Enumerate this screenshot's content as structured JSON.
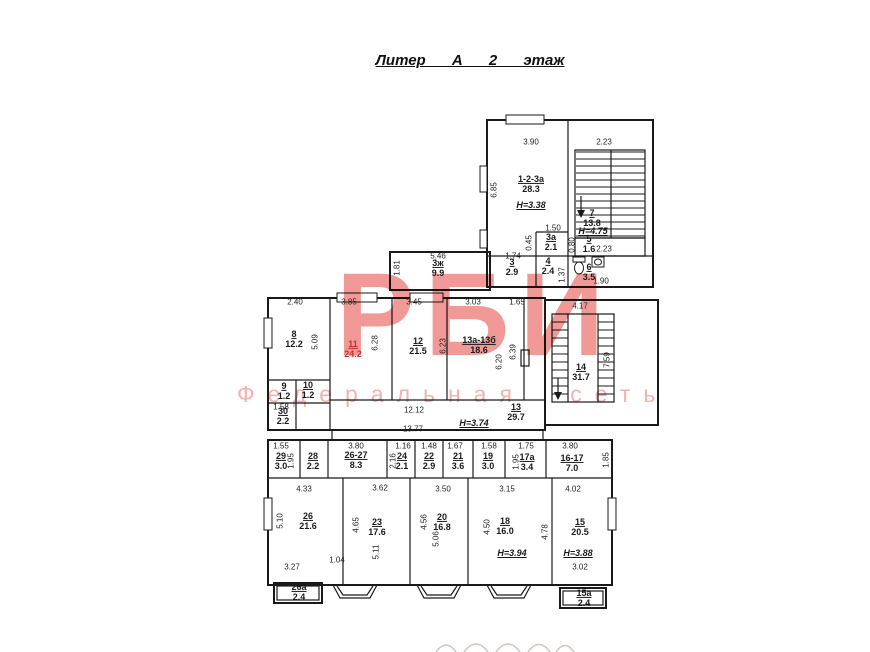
{
  "title": "Литер А 2 этаж",
  "watermark": {
    "big": "РБИ",
    "sub": "Федеральная сеть",
    "big_color": "#ee837f",
    "sub_color": "#f1aeac"
  },
  "rooms": [
    {
      "num": "1-2-3а",
      "area": "28.3",
      "x": 531,
      "y": 184
    },
    {
      "num": "7",
      "area": "13.8",
      "x": 592,
      "y": 218
    },
    {
      "num": "5",
      "area": "1.6",
      "x": 589,
      "y": 244
    },
    {
      "num": "3а",
      "area": "2.1",
      "x": 551,
      "y": 242
    },
    {
      "num": "3",
      "area": "2.9",
      "x": 512,
      "y": 267
    },
    {
      "num": "4",
      "area": "2.4",
      "x": 548,
      "y": 266
    },
    {
      "num": "6",
      "area": "3.5",
      "x": 589,
      "y": 272
    },
    {
      "num": "3ж",
      "area": "9.9",
      "x": 438,
      "y": 268
    },
    {
      "num": "8",
      "area": "12.2",
      "x": 294,
      "y": 339
    },
    {
      "num": "11",
      "area": "24.2",
      "x": 353,
      "y": 349,
      "color": "#c9302f"
    },
    {
      "num": "12",
      "area": "21.5",
      "x": 418,
      "y": 346
    },
    {
      "num": "13а-13б",
      "area": "18.6",
      "x": 479,
      "y": 345
    },
    {
      "num": "9",
      "area": "1.2",
      "x": 284,
      "y": 391
    },
    {
      "num": "10",
      "area": "1.2",
      "x": 308,
      "y": 390
    },
    {
      "num": "30",
      "area": "2.2",
      "x": 283,
      "y": 416
    },
    {
      "num": "13",
      "area": "29.7",
      "x": 516,
      "y": 412
    },
    {
      "num": "14",
      "area": "31.7",
      "x": 581,
      "y": 372
    },
    {
      "num": "29",
      "area": "3.0",
      "x": 281,
      "y": 461
    },
    {
      "num": "28",
      "area": "2.2",
      "x": 313,
      "y": 461
    },
    {
      "num": "26-27",
      "area": "8.3",
      "x": 356,
      "y": 460
    },
    {
      "num": "24",
      "area": "2.1",
      "x": 402,
      "y": 461
    },
    {
      "num": "22",
      "area": "2.9",
      "x": 429,
      "y": 461
    },
    {
      "num": "21",
      "area": "3.6",
      "x": 458,
      "y": 461
    },
    {
      "num": "19",
      "area": "3.0",
      "x": 488,
      "y": 461
    },
    {
      "num": "17а",
      "area": "3.4",
      "x": 527,
      "y": 462
    },
    {
      "num": "16-17",
      "area": "7.0",
      "x": 572,
      "y": 463
    },
    {
      "num": "26",
      "area": "21.6",
      "x": 308,
      "y": 521
    },
    {
      "num": "23",
      "area": "17.6",
      "x": 377,
      "y": 527
    },
    {
      "num": "20",
      "area": "16.8",
      "x": 442,
      "y": 522
    },
    {
      "num": "18",
      "area": "16.0",
      "x": 505,
      "y": 526
    },
    {
      "num": "15",
      "area": "20.5",
      "x": 580,
      "y": 527
    },
    {
      "num": "26а",
      "area": "2.4",
      "x": 299,
      "y": 592
    },
    {
      "num": "15а",
      "area": "2.4",
      "x": 584,
      "y": 598
    }
  ],
  "hlabels": [
    {
      "text": "Н=3.38",
      "x": 531,
      "y": 205
    },
    {
      "text": "Н=4.75",
      "x": 593,
      "y": 231
    },
    {
      "text": "Н=3.74",
      "x": 474,
      "y": 423
    },
    {
      "text": "Н=3.94",
      "x": 512,
      "y": 553
    },
    {
      "text": "Н=3.88",
      "x": 578,
      "y": 553
    }
  ],
  "dims": [
    {
      "t": "3.90",
      "x": 531,
      "y": 142
    },
    {
      "t": "2.23",
      "x": 604,
      "y": 142
    },
    {
      "t": "6.85",
      "x": 494,
      "y": 190,
      "r": 1
    },
    {
      "t": "1.50",
      "x": 553,
      "y": 228
    },
    {
      "t": "0.45",
      "x": 529,
      "y": 243,
      "r": 1
    },
    {
      "t": "1.74",
      "x": 513,
      "y": 256
    },
    {
      "t": "0.80",
      "x": 572,
      "y": 245,
      "r": 1
    },
    {
      "t": "2.23",
      "x": 604,
      "y": 249
    },
    {
      "t": "1.37",
      "x": 562,
      "y": 275,
      "r": 1
    },
    {
      "t": "1.90",
      "x": 601,
      "y": 281
    },
    {
      "t": "5.46",
      "x": 438,
      "y": 256
    },
    {
      "t": "1.81",
      "x": 397,
      "y": 268,
      "r": 1
    },
    {
      "t": "2.40",
      "x": 295,
      "y": 302
    },
    {
      "t": "3.85",
      "x": 349,
      "y": 302
    },
    {
      "t": "3.45",
      "x": 414,
      "y": 302
    },
    {
      "t": "3.03",
      "x": 473,
      "y": 302
    },
    {
      "t": "1.65",
      "x": 517,
      "y": 302
    },
    {
      "t": "5.09",
      "x": 315,
      "y": 342,
      "r": 1
    },
    {
      "t": "6.28",
      "x": 375,
      "y": 343,
      "r": 1
    },
    {
      "t": "6.23",
      "x": 443,
      "y": 346,
      "r": 1
    },
    {
      "t": "6.20",
      "x": 499,
      "y": 362,
      "r": 1
    },
    {
      "t": "6.39",
      "x": 513,
      "y": 352,
      "r": 1
    },
    {
      "t": "4.17",
      "x": 580,
      "y": 306
    },
    {
      "t": "7.59",
      "x": 607,
      "y": 360,
      "r": 1
    },
    {
      "t": "1.58",
      "x": 281,
      "y": 407
    },
    {
      "t": "12.12",
      "x": 414,
      "y": 410
    },
    {
      "t": "13.77",
      "x": 413,
      "y": 429
    },
    {
      "t": "1.55",
      "x": 281,
      "y": 446
    },
    {
      "t": "1.95",
      "x": 291,
      "y": 461,
      "r": 1
    },
    {
      "t": "3.80",
      "x": 356,
      "y": 446
    },
    {
      "t": "1.16",
      "x": 403,
      "y": 446
    },
    {
      "t": "2.16",
      "x": 393,
      "y": 461,
      "r": 1
    },
    {
      "t": "1.48",
      "x": 429,
      "y": 446
    },
    {
      "t": "1.67",
      "x": 455,
      "y": 446
    },
    {
      "t": "1.58",
      "x": 489,
      "y": 446
    },
    {
      "t": "1.75",
      "x": 526,
      "y": 446
    },
    {
      "t": "1.95",
      "x": 516,
      "y": 462,
      "r": 1
    },
    {
      "t": "3.80",
      "x": 570,
      "y": 446
    },
    {
      "t": "1.85",
      "x": 606,
      "y": 460,
      "r": 1
    },
    {
      "t": "4.33",
      "x": 304,
      "y": 489
    },
    {
      "t": "5.10",
      "x": 280,
      "y": 521,
      "r": 1
    },
    {
      "t": "3.27",
      "x": 292,
      "y": 567
    },
    {
      "t": "1.04",
      "x": 337,
      "y": 560
    },
    {
      "t": "3.62",
      "x": 380,
      "y": 488
    },
    {
      "t": "4.65",
      "x": 356,
      "y": 525,
      "r": 1
    },
    {
      "t": "5.11",
      "x": 376,
      "y": 552,
      "r": 1
    },
    {
      "t": "3.50",
      "x": 443,
      "y": 489
    },
    {
      "t": "4.56",
      "x": 424,
      "y": 522,
      "r": 1
    },
    {
      "t": "5.06",
      "x": 436,
      "y": 539,
      "r": 1
    },
    {
      "t": "3.15",
      "x": 507,
      "y": 489
    },
    {
      "t": "4.50",
      "x": 487,
      "y": 527,
      "r": 1
    },
    {
      "t": "4.78",
      "x": 545,
      "y": 532,
      "r": 1
    },
    {
      "t": "4.02",
      "x": 573,
      "y": 489
    },
    {
      "t": "3.02",
      "x": 580,
      "y": 567
    }
  ]
}
